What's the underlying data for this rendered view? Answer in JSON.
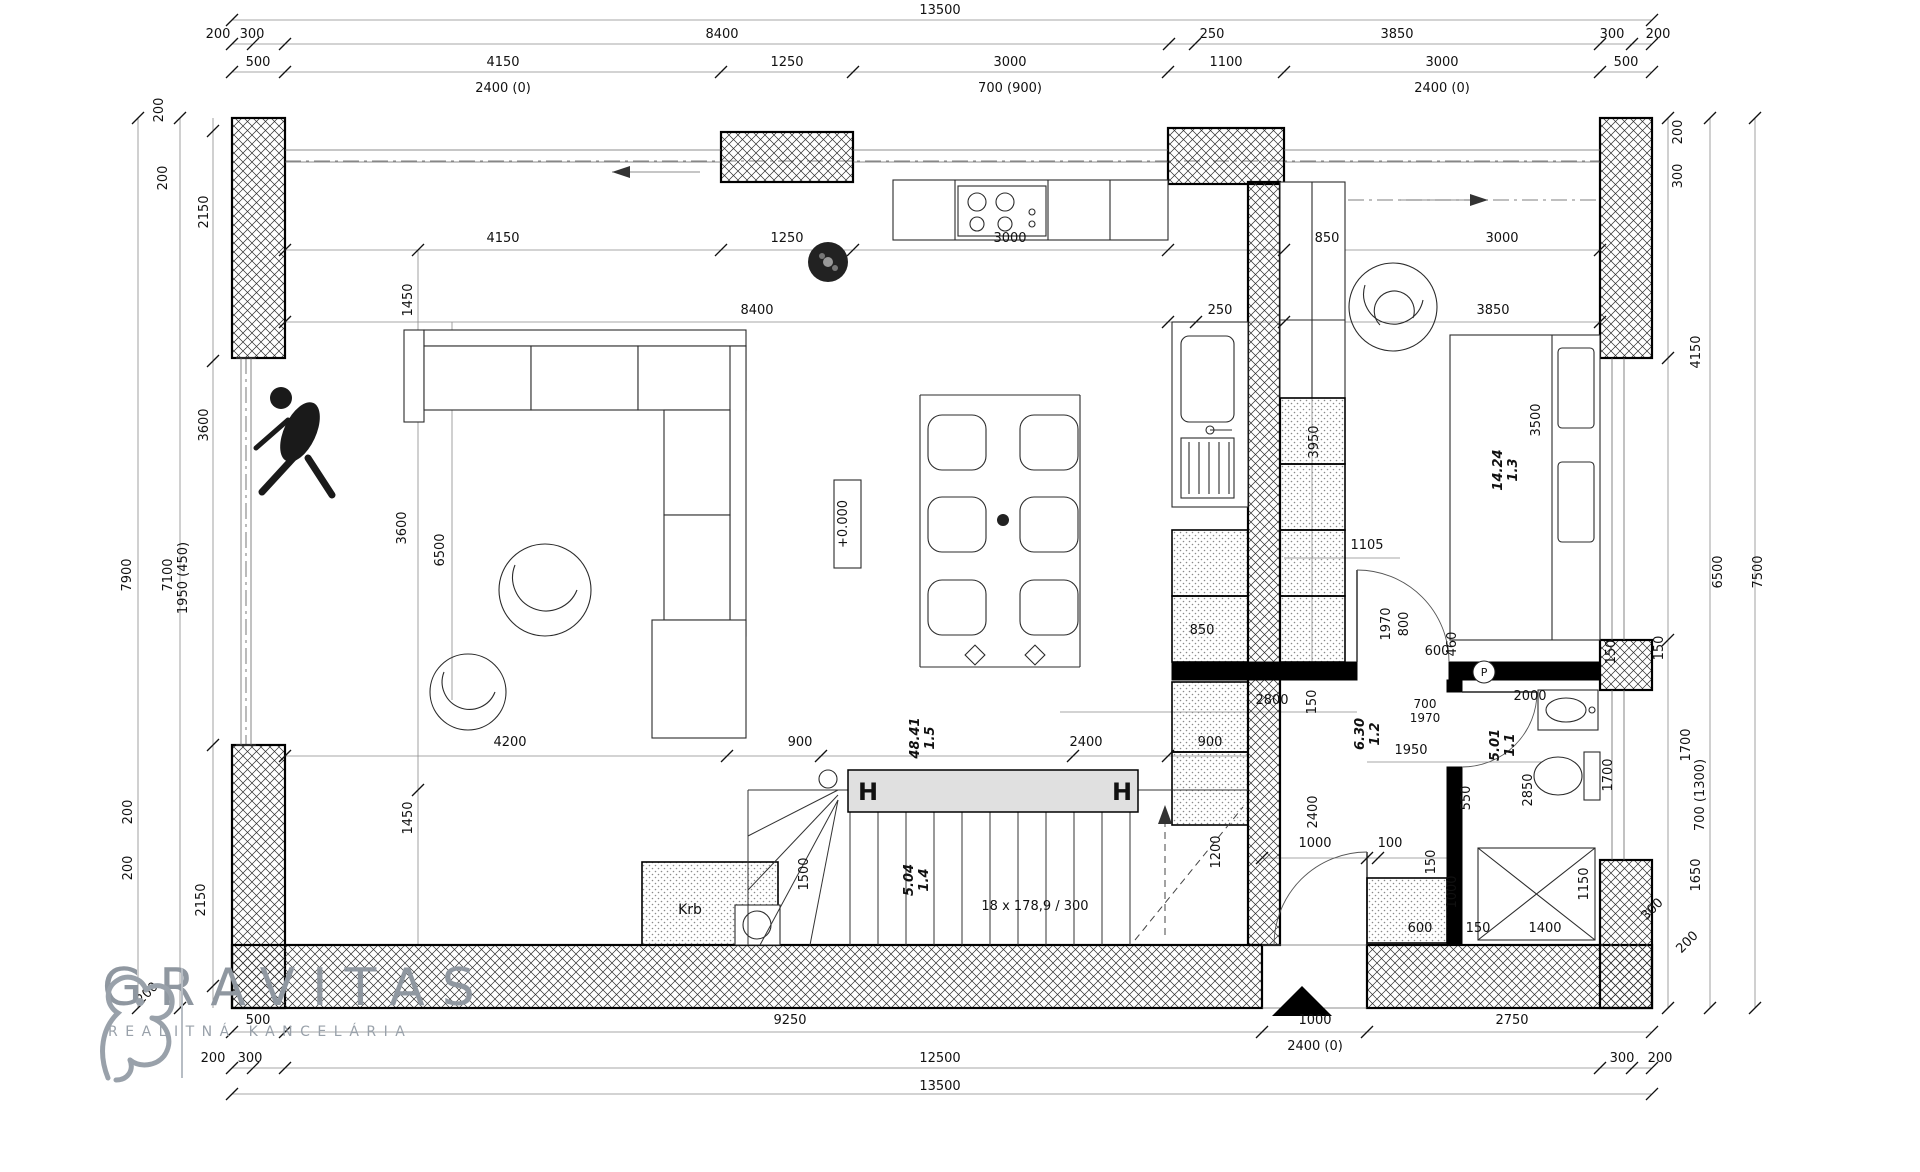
{
  "logo": {
    "title": "GRAVITAS",
    "subtitle": "REALITNÁ KANCELÁRIA"
  },
  "rooms": [
    {
      "id": "1.1",
      "area": "5.01"
    },
    {
      "id": "1.2",
      "area": "6.30"
    },
    {
      "id": "1.3",
      "area": "14.24"
    },
    {
      "id": "1.4",
      "area": "5.04"
    },
    {
      "id": "1.5",
      "area": "48.41"
    }
  ],
  "annotations": {
    "stairs": "18 x 178,9 / 300",
    "elevation": "+0.000",
    "fireplace": "Krb",
    "steel_column": "H",
    "pipe_marker": "P"
  },
  "colors": {
    "walls": "#000000",
    "dims": "#8a8a8a",
    "beam_fill": "#e0e0e0",
    "logo_gray": "#8f97a0"
  },
  "labels": [
    {
      "t": "13500",
      "x": 940,
      "y": 14
    },
    {
      "t": "200",
      "x": 218,
      "y": 38
    },
    {
      "t": "300",
      "x": 252,
      "y": 38
    },
    {
      "t": "8400",
      "x": 722,
      "y": 38
    },
    {
      "t": "250",
      "x": 1212,
      "y": 38
    },
    {
      "t": "3850",
      "x": 1397,
      "y": 38
    },
    {
      "t": "300",
      "x": 1612,
      "y": 38
    },
    {
      "t": "200",
      "x": 1658,
      "y": 38
    },
    {
      "t": "500",
      "x": 258,
      "y": 66
    },
    {
      "t": "4150",
      "x": 503,
      "y": 66
    },
    {
      "t": "1250",
      "x": 787,
      "y": 66
    },
    {
      "t": "3000",
      "x": 1010,
      "y": 66
    },
    {
      "t": "1100",
      "x": 1226,
      "y": 66
    },
    {
      "t": "3000",
      "x": 1442,
      "y": 66
    },
    {
      "t": "500",
      "x": 1626,
      "y": 66
    },
    {
      "t": "2400 (0)",
      "x": 503,
      "y": 92
    },
    {
      "t": "700 (900)",
      "x": 1010,
      "y": 92
    },
    {
      "t": "2400 (0)",
      "x": 1442,
      "y": 92
    },
    {
      "t": "200",
      "x": 163,
      "y": 110,
      "r": -90
    },
    {
      "t": "200",
      "x": 167,
      "y": 178,
      "r": -90
    },
    {
      "t": "2150",
      "x": 208,
      "y": 212,
      "r": -90
    },
    {
      "t": "3600",
      "x": 208,
      "y": 425,
      "r": -90
    },
    {
      "t": "2150",
      "x": 205,
      "y": 900,
      "r": -90
    },
    {
      "t": "1950 (450)",
      "x": 187,
      "y": 578,
      "r": -90
    },
    {
      "t": "7100",
      "x": 172,
      "y": 575,
      "r": -90
    },
    {
      "t": "7900",
      "x": 131,
      "y": 575,
      "r": -90
    },
    {
      "t": "200",
      "x": 132,
      "y": 812,
      "r": -90
    },
    {
      "t": "200",
      "x": 132,
      "y": 868,
      "r": -90
    },
    {
      "t": "200",
      "x": 150,
      "y": 996,
      "r": -45
    },
    {
      "t": "200",
      "x": 1682,
      "y": 132,
      "r": -90
    },
    {
      "t": "300",
      "x": 1682,
      "y": 176,
      "r": -90
    },
    {
      "t": "4150",
      "x": 1700,
      "y": 352,
      "r": -90
    },
    {
      "t": "6500",
      "x": 1722,
      "y": 572,
      "r": -90
    },
    {
      "t": "7500",
      "x": 1762,
      "y": 572,
      "r": -90
    },
    {
      "t": "150",
      "x": 1663,
      "y": 648,
      "r": -90
    },
    {
      "t": "1700",
      "x": 1690,
      "y": 745,
      "r": -90
    },
    {
      "t": "700 (1300)",
      "x": 1704,
      "y": 795,
      "r": -90
    },
    {
      "t": "1650",
      "x": 1700,
      "y": 875,
      "r": -90
    },
    {
      "t": "300",
      "x": 1655,
      "y": 912,
      "r": -45
    },
    {
      "t": "200",
      "x": 1690,
      "y": 945,
      "r": -45
    },
    {
      "t": "4150",
      "x": 503,
      "y": 242
    },
    {
      "t": "1250",
      "x": 787,
      "y": 242
    },
    {
      "t": "3000",
      "x": 1010,
      "y": 242
    },
    {
      "t": "850",
      "x": 1327,
      "y": 242
    },
    {
      "t": "3000",
      "x": 1502,
      "y": 242
    },
    {
      "t": "8400",
      "x": 757,
      "y": 314
    },
    {
      "t": "250",
      "x": 1220,
      "y": 314
    },
    {
      "t": "3850",
      "x": 1493,
      "y": 314
    },
    {
      "t": "1450",
      "x": 412,
      "y": 300,
      "r": -90
    },
    {
      "t": "3600",
      "x": 406,
      "y": 528,
      "r": -90
    },
    {
      "t": "6500",
      "x": 444,
      "y": 550,
      "r": -90
    },
    {
      "t": "1450",
      "x": 412,
      "y": 818,
      "r": -90
    },
    {
      "t": "3950",
      "x": 1318,
      "y": 442,
      "r": -90
    },
    {
      "t": "850",
      "x": 1202,
      "y": 634
    },
    {
      "t": "2800",
      "x": 1272,
      "y": 704
    },
    {
      "t": "150",
      "x": 1316,
      "y": 702,
      "r": -90
    },
    {
      "t": "1105",
      "x": 1367,
      "y": 549
    },
    {
      "t": "1970",
      "x": 1390,
      "y": 624,
      "r": -90
    },
    {
      "t": "800",
      "x": 1408,
      "y": 624,
      "r": -90
    },
    {
      "t": "460",
      "x": 1456,
      "y": 644,
      "r": -90
    },
    {
      "t": "1.2",
      "t2": "6.30",
      "x": 1367,
      "y": 734,
      "r": -90,
      "room": true
    },
    {
      "t": "1950",
      "x": 1411,
      "y": 754
    },
    {
      "t": "2400",
      "x": 1317,
      "y": 812,
      "r": -90
    },
    {
      "t": "600",
      "x": 1437,
      "y": 655
    },
    {
      "t": "2000",
      "x": 1530,
      "y": 700
    },
    {
      "t": "700",
      "x": 1425,
      "y": 708,
      "s": 12
    },
    {
      "t": "1970",
      "x": 1425,
      "y": 722,
      "s": 12
    },
    {
      "t": "550",
      "x": 1470,
      "y": 798,
      "r": -90
    },
    {
      "t": "1.1",
      "t2": "5.01",
      "x": 1502,
      "y": 745,
      "r": -90,
      "room": true
    },
    {
      "t": "2850",
      "x": 1532,
      "y": 790,
      "r": -90
    },
    {
      "t": "1700",
      "x": 1612,
      "y": 775,
      "r": -90
    },
    {
      "t": "P",
      "x": 1484,
      "y": 676,
      "s": 11
    },
    {
      "t": "1000",
      "x": 1315,
      "y": 847
    },
    {
      "t": "100",
      "x": 1390,
      "y": 847
    },
    {
      "t": "150",
      "x": 1435,
      "y": 862,
      "r": -90
    },
    {
      "t": "1000",
      "x": 1456,
      "y": 892,
      "r": -90
    },
    {
      "t": "600",
      "x": 1420,
      "y": 932
    },
    {
      "t": "150",
      "x": 1478,
      "y": 932
    },
    {
      "t": "1400",
      "x": 1545,
      "y": 932
    },
    {
      "t": "1150",
      "x": 1588,
      "y": 884,
      "r": -90
    },
    {
      "t": "3500",
      "x": 1540,
      "y": 420,
      "r": -90
    },
    {
      "t": "1.3",
      "t2": "14.24",
      "x": 1505,
      "y": 470,
      "r": -90,
      "room": true
    },
    {
      "t": "150",
      "x": 1615,
      "y": 652,
      "r": -90
    },
    {
      "t": "4200",
      "x": 510,
      "y": 746
    },
    {
      "t": "900",
      "x": 800,
      "y": 746
    },
    {
      "t": "2400",
      "x": 1086,
      "y": 746
    },
    {
      "t": "900",
      "x": 1210,
      "y": 746
    },
    {
      "t": "1.5",
      "t2": "48.41",
      "x": 922,
      "y": 738,
      "r": -90,
      "room": true
    },
    {
      "t": "+0.000",
      "x": 847,
      "y": 524,
      "r": -90
    },
    {
      "t": "Krb",
      "x": 690,
      "y": 914,
      "s": 14
    },
    {
      "t": "1500",
      "x": 808,
      "y": 874,
      "r": -90
    },
    {
      "t": "1200",
      "x": 1220,
      "y": 852,
      "r": -90
    },
    {
      "t": "1.4",
      "t2": "5.04",
      "x": 916,
      "y": 880,
      "r": -90,
      "room": true
    },
    {
      "t": "18 x 178,9 / 300",
      "x": 1035,
      "y": 910
    },
    {
      "t": "H",
      "x": 868,
      "y": 800,
      "s": 24,
      "b": true
    },
    {
      "t": "H",
      "x": 1122,
      "y": 800,
      "s": 24,
      "b": true
    },
    {
      "t": "500",
      "x": 258,
      "y": 1024
    },
    {
      "t": "9250",
      "x": 790,
      "y": 1024
    },
    {
      "t": "1000",
      "x": 1315,
      "y": 1024
    },
    {
      "t": "2750",
      "x": 1512,
      "y": 1024
    },
    {
      "t": "2400 (0)",
      "x": 1315,
      "y": 1050
    },
    {
      "t": "200",
      "x": 213,
      "y": 1062
    },
    {
      "t": "300",
      "x": 250,
      "y": 1062
    },
    {
      "t": "12500",
      "x": 940,
      "y": 1062
    },
    {
      "t": "300",
      "x": 1622,
      "y": 1062
    },
    {
      "t": "200",
      "x": 1660,
      "y": 1062
    },
    {
      "t": "13500",
      "x": 940,
      "y": 1090
    }
  ],
  "ticks": [
    [
      232,
      44
    ],
    [
      253,
      44
    ],
    [
      285,
      44
    ],
    [
      1169,
      44
    ],
    [
      1195,
      44
    ],
    [
      1600,
      44
    ],
    [
      1632,
      44
    ],
    [
      1652,
      44
    ],
    [
      232,
      72
    ],
    [
      285,
      72
    ],
    [
      721,
      72
    ],
    [
      853,
      72
    ],
    [
      1168,
      72
    ],
    [
      1284,
      72
    ],
    [
      1600,
      72
    ],
    [
      1652,
      72
    ],
    [
      232,
      20
    ],
    [
      1652,
      20
    ],
    [
      285,
      250
    ],
    [
      721,
      250
    ],
    [
      853,
      250
    ],
    [
      1168,
      250
    ],
    [
      1284,
      250
    ],
    [
      1600,
      250
    ],
    [
      285,
      322
    ],
    [
      1168,
      322
    ],
    [
      1196,
      322
    ],
    [
      1284,
      322
    ],
    [
      1600,
      322
    ],
    [
      285,
      756
    ],
    [
      727,
      756
    ],
    [
      821,
      756
    ],
    [
      1073,
      756
    ],
    [
      1168,
      756
    ],
    [
      1262,
      858
    ],
    [
      1367,
      858
    ],
    [
      1378,
      858
    ],
    [
      232,
      1032
    ],
    [
      285,
      1032
    ],
    [
      1262,
      1032
    ],
    [
      1367,
      1032
    ],
    [
      1652,
      1032
    ],
    [
      232,
      1068
    ],
    [
      253,
      1068
    ],
    [
      285,
      1068
    ],
    [
      1600,
      1068
    ],
    [
      1632,
      1068
    ],
    [
      1652,
      1068
    ],
    [
      232,
      1094
    ],
    [
      1652,
      1094
    ],
    [
      213,
      131
    ],
    [
      213,
      361
    ],
    [
      213,
      745
    ],
    [
      213,
      986
    ],
    [
      180,
      118
    ],
    [
      180,
      1008
    ],
    [
      138,
      118
    ],
    [
      138,
      1008
    ],
    [
      1668,
      118
    ],
    [
      1668,
      358
    ],
    [
      1668,
      640
    ],
    [
      1668,
      1008
    ],
    [
      1710,
      118
    ],
    [
      1710,
      1008
    ],
    [
      1755,
      118
    ],
    [
      1755,
      1008
    ],
    [
      418,
      250
    ],
    [
      418,
      790
    ]
  ]
}
